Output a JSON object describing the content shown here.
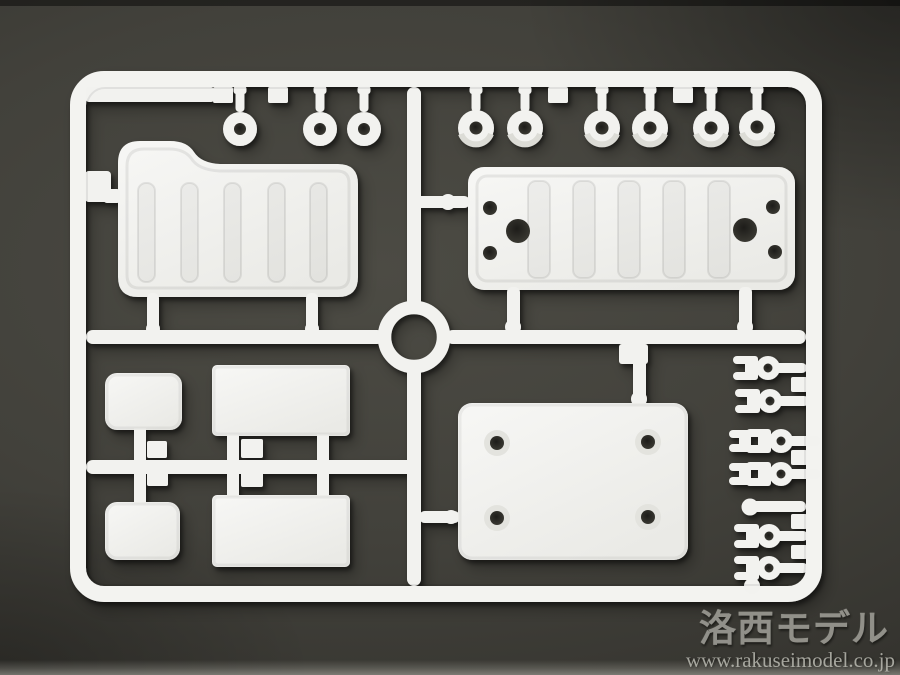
{
  "watermark": {
    "title": "洛西モデル",
    "url": "www.rakuseimodel.co.jp"
  },
  "colors": {
    "background": "#42413b",
    "plastic": "#f2f2ef",
    "plastic_shade": "#e2e2dd",
    "hole": "#2c2b27",
    "watermark_text": "#9e9d96",
    "watermark_url": "#aaaaa2"
  },
  "scene": {
    "subject": "white plastic model kit sprue on dark surface",
    "parts": [
      {
        "name": "sprue-frame",
        "count": 1
      },
      {
        "name": "molded-label-tab",
        "count": 1
      },
      {
        "name": "small-grommet",
        "count": 3
      },
      {
        "name": "round-bushing",
        "count": 6
      },
      {
        "name": "ribbed-canopy-panel",
        "count": 1
      },
      {
        "name": "ribbed-bed-plate",
        "count": 1
      },
      {
        "name": "center-ring",
        "count": 1
      },
      {
        "name": "small-rounded-plate",
        "count": 2
      },
      {
        "name": "rectangular-plate",
        "count": 2
      },
      {
        "name": "base-plate-with-holes",
        "count": 1
      },
      {
        "name": "clevis-fork",
        "count": 6
      }
    ]
  }
}
